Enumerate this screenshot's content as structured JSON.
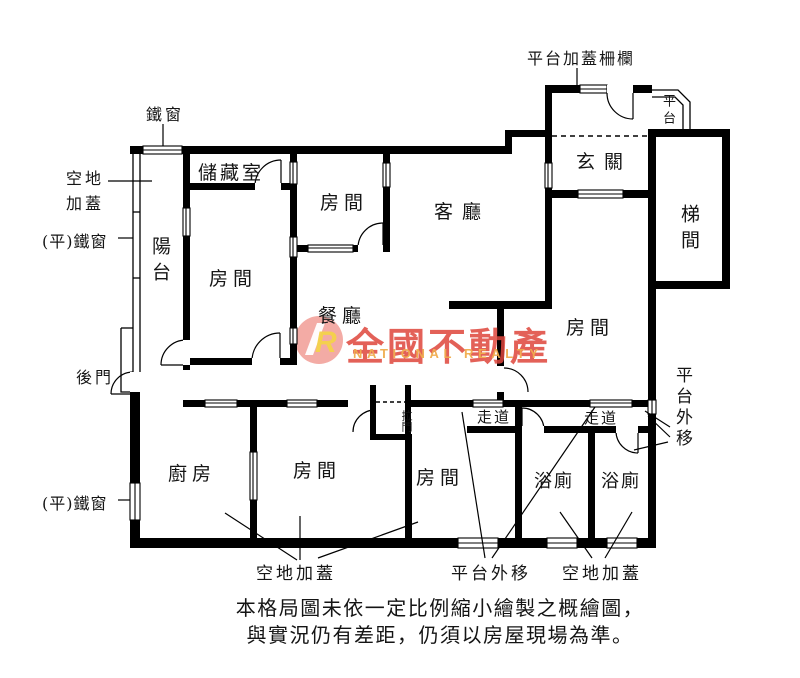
{
  "watermark": {
    "brand_zh": "全國不動產",
    "brand_en": "NATIONAL REALTY",
    "logo_letter": "R"
  },
  "colors": {
    "wall": "#000000",
    "brand_red": "#df463c",
    "brand_orange": "#f0ac4e",
    "brand_pink": "#f2a29b",
    "logo_yellow": "#f5d24a"
  },
  "rooms": {
    "storage": "儲藏室",
    "balcony": "陽台",
    "bedroom_top_left": "房間",
    "bedroom_top_mid": "房間",
    "living": "客廳",
    "entry": "玄關",
    "stairwell": "梯間",
    "dining": "餐廳",
    "bedroom_right": "房間",
    "kitchen": "廚房",
    "bedroom_bottom_left": "房間",
    "bedroom_bottom_mid": "房間",
    "bath_1": "浴廁",
    "bath_2": "浴廁",
    "corridor_1": "走道",
    "corridor_2": "走道",
    "platform_top": "平台",
    "sliding_door": "拉門"
  },
  "callouts": {
    "iron_window_top": "鐵窗",
    "open_land_addition_line1": "空地",
    "open_land_addition_line2": "加蓋",
    "flat_iron_window_1": "(平)鐵窗",
    "flat_iron_window_2": "(平)鐵窗",
    "back_door": "後門",
    "platform_addition_fence": "平台加蓋柵欄",
    "platform_moved_out_right": "平台外移",
    "platform_moved_out_bottom": "平台外移",
    "open_land_addition_bottom_left": "空地加蓋",
    "open_land_addition_bottom_right": "空地加蓋"
  },
  "disclaimer": {
    "line1": "本格局圖未依一定比例縮小繪製之概繪圖，",
    "line2": "與實況仍有差距，仍須以房屋現場為準。"
  }
}
